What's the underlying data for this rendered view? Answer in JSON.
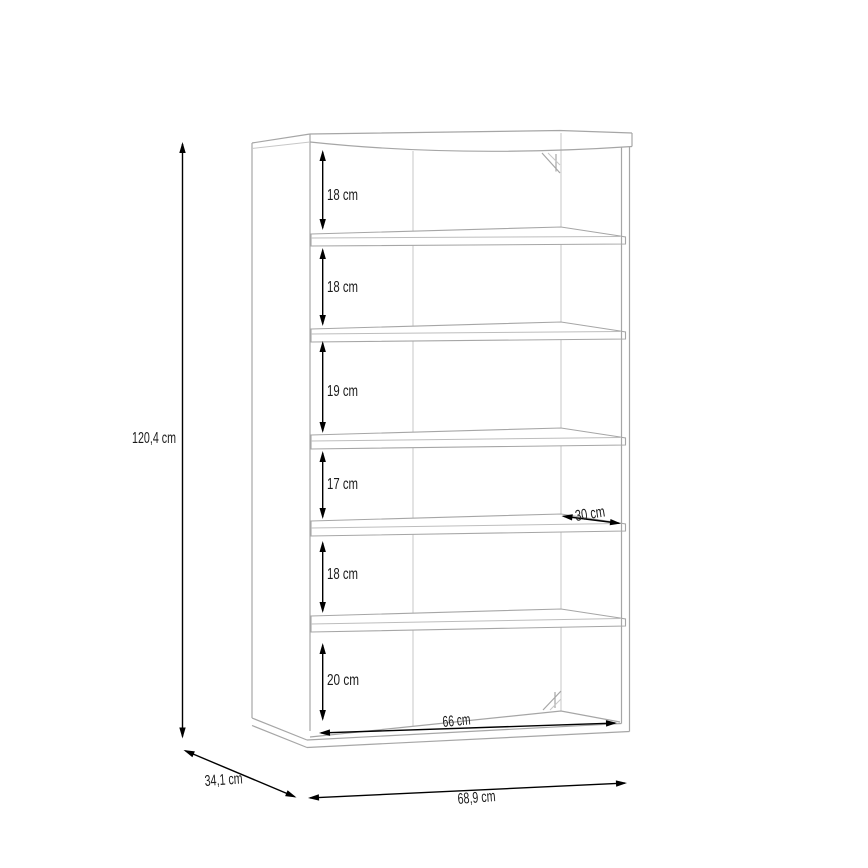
{
  "diagram": {
    "type": "furniture-dimension-drawing",
    "subject": "open shelf cabinet with 5 shelves / 6 compartments",
    "unit": "cm",
    "overall": {
      "height_label": "120,4 cm",
      "depth_label": "34,1 cm",
      "width_label": "68,9 cm"
    },
    "interior": {
      "inner_width_label": "66 cm",
      "shelf_depth_label": "30 cm"
    },
    "compartments": [
      {
        "index": 1,
        "label": "18 cm",
        "value": 18
      },
      {
        "index": 2,
        "label": "18 cm",
        "value": 18
      },
      {
        "index": 3,
        "label": "19 cm",
        "value": 19
      },
      {
        "index": 4,
        "label": "17 cm",
        "value": 17
      },
      {
        "index": 5,
        "label": "18 cm",
        "value": 18
      },
      {
        "index": 6,
        "label": "20 cm",
        "value": 20
      }
    ],
    "colors": {
      "background": "#ffffff",
      "furniture_line": "#a6a6a6",
      "dimension_line": "#000000",
      "text": "#1a1a1a"
    }
  }
}
